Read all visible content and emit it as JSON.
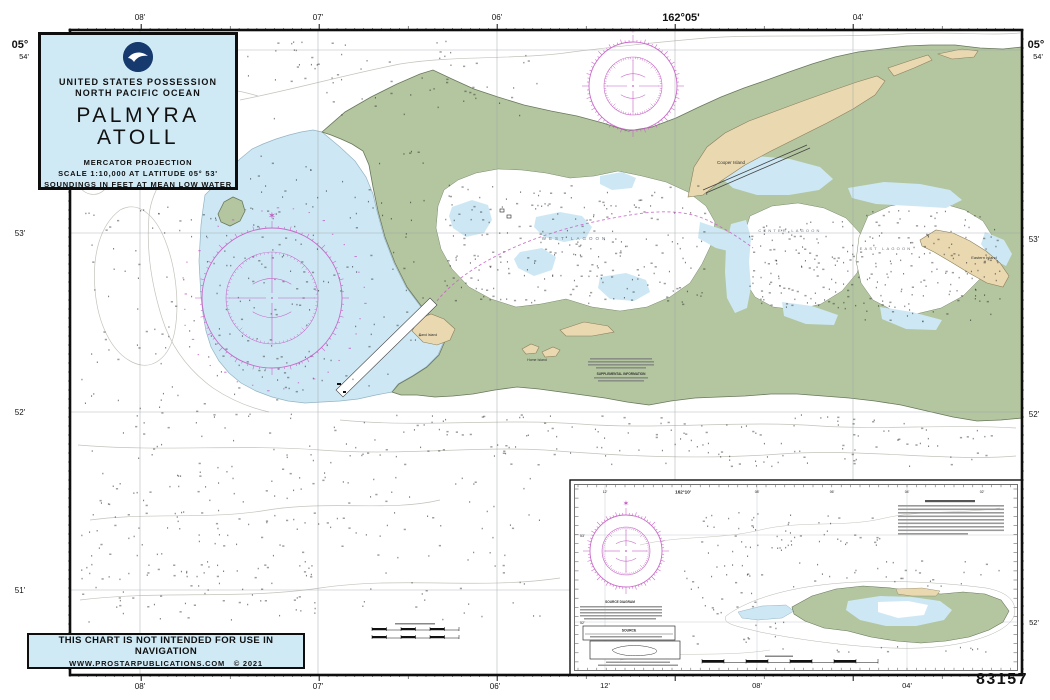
{
  "title_block": {
    "possession": "UNITED STATES POSSESSION",
    "ocean": "NORTH PACIFIC OCEAN",
    "title_line1": "PALMYRA",
    "title_line2": "ATOLL",
    "projection": "MERCATOR PROJECTION",
    "scale": "SCALE 1:10,000 AT LATITUDE 05° 53'",
    "soundings": "SOUNDINGS IN FEET AT MEAN LOW WATER"
  },
  "disclaimer": {
    "line1": "THIS CHART IS NOT INTENDED FOR USE IN NAVIGATION",
    "line2": "WWW.PROSTARPUBLICATIONS.COM",
    "copyright": "© 2021"
  },
  "chart_number": "83157",
  "margin": {
    "top": [
      "08'",
      "07'",
      "06'",
      "162°05'",
      "04'"
    ],
    "bottom": [
      "08'",
      "07'",
      "06'",
      "12'",
      "08'",
      "04'"
    ],
    "left": [
      "05°",
      "54'",
      "53'",
      "52'",
      "51'"
    ],
    "right": [
      "05°",
      "54'",
      "53'",
      "52'",
      "52'"
    ]
  },
  "places": {
    "cooper": "Cooper Island",
    "eastern": "Eastern Island",
    "sand": "Sand Island",
    "home": "Home Island",
    "west_lagoon": "WEST LAGOON",
    "center_lagoon": "CENTER LAGOON",
    "east_lagoon": "EAST LAGOON"
  },
  "notes": {
    "supplemental_heading": "SUPPLEMENTAL INFORMATION"
  },
  "inset": {
    "top_label": "162°10'",
    "lat_labels": [
      "53'",
      "52'"
    ],
    "lon_labels": [
      "12'",
      "08'",
      "06'",
      "04'",
      "02'"
    ],
    "source_diagram_heading": "SOURCE DIAGRAM",
    "source_table_heading": "SOURCE"
  },
  "colors": {
    "land_green": "#b3c6a0",
    "land_outline": "#69785c",
    "shallow_blue": "#cde8f4",
    "sand_tan": "#ead9b0",
    "magenta": "#c45ec4",
    "box_blue": "#cfe9f5"
  }
}
